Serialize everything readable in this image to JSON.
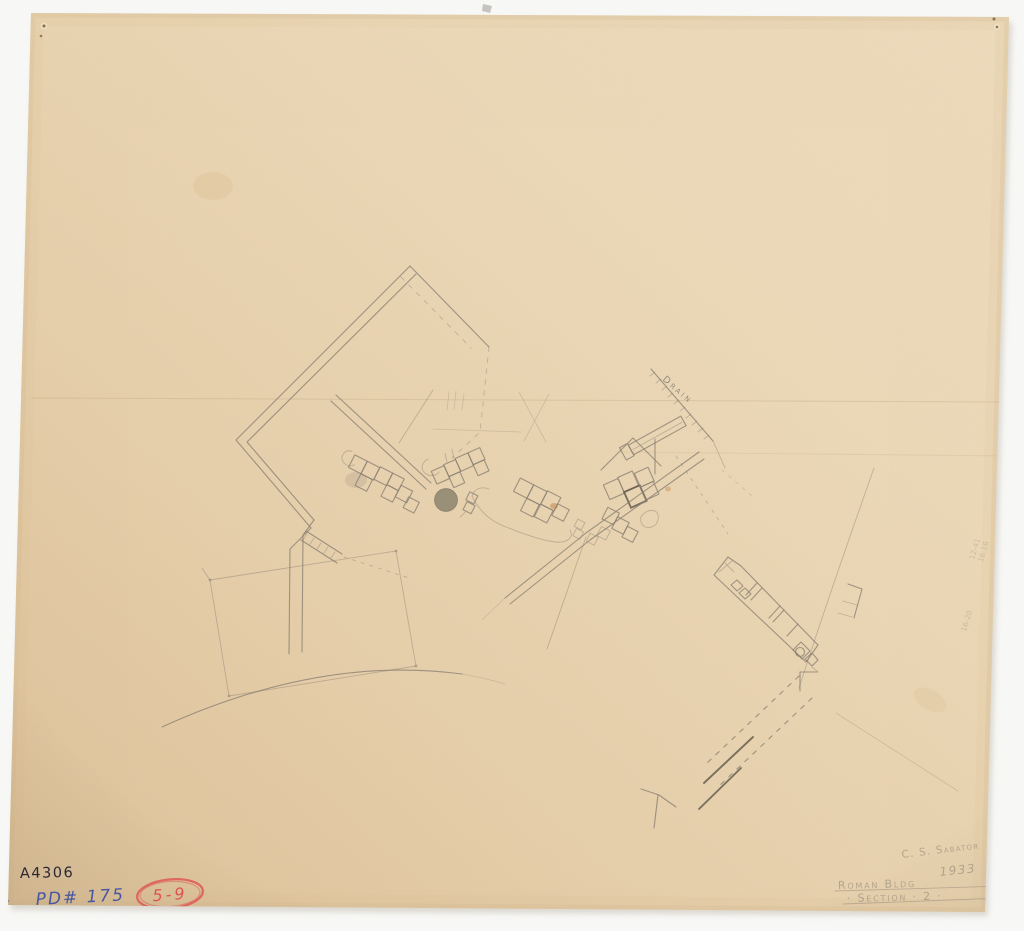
{
  "annotations": {
    "catalog_number": "A4306",
    "drawing_number": "PD# 175",
    "red_label": "5-9",
    "signature": "C. S. Sabator",
    "year": "1933",
    "title_line1": "Roman Bldg",
    "title_line2": "· Section · 2 ·",
    "drain_label": "Drain",
    "faint_measurements": [
      "12-41",
      "16.16",
      "16-20"
    ]
  },
  "colors": {
    "paper": "#e8d3b0",
    "paper_edge": "#d3b68c",
    "background": "#f7f7f5",
    "pencil": "#8b8173",
    "pencil_dark": "#5f574a",
    "ink": "#2b2733",
    "blue_pencil": "#4757a2",
    "red_pencil": "#de5350"
  }
}
